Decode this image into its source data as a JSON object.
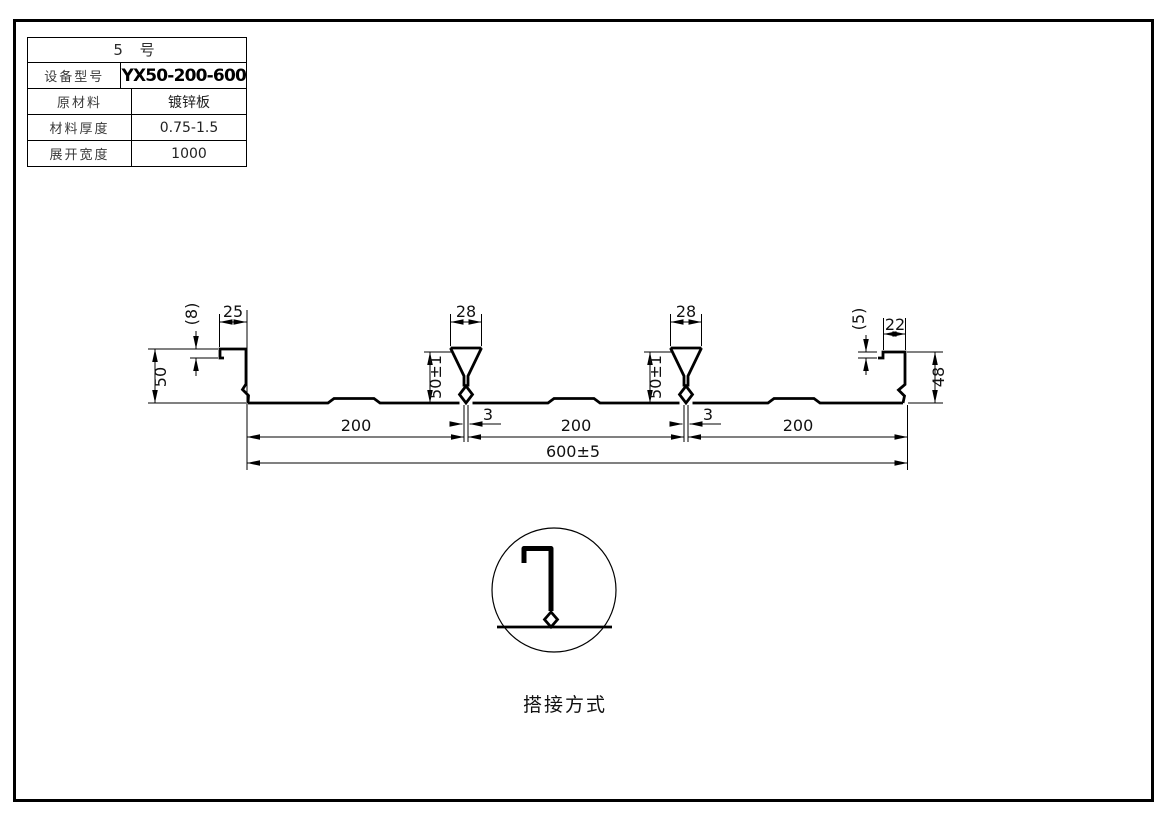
{
  "table": {
    "title": "5 号",
    "rows": [
      {
        "label": "设备型号",
        "value": "YX50-200-600"
      },
      {
        "label": "原材料",
        "value": "镀锌板"
      },
      {
        "label": "材料厚度",
        "value": "0.75-1.5"
      },
      {
        "label": "展开宽度",
        "value": "1000"
      }
    ]
  },
  "drawing": {
    "dims": {
      "left_lip_height": "(8)",
      "left_flange_width": "25",
      "left_height": "50",
      "rib_top_width": "28",
      "rib_height": "50±1",
      "rib_stem_gap": "3",
      "right_lip_height": "(5)",
      "right_flange_width": "22",
      "right_height": "48",
      "pitch": "200",
      "overall_width": "600±5"
    },
    "detail_caption": "搭接方式"
  }
}
